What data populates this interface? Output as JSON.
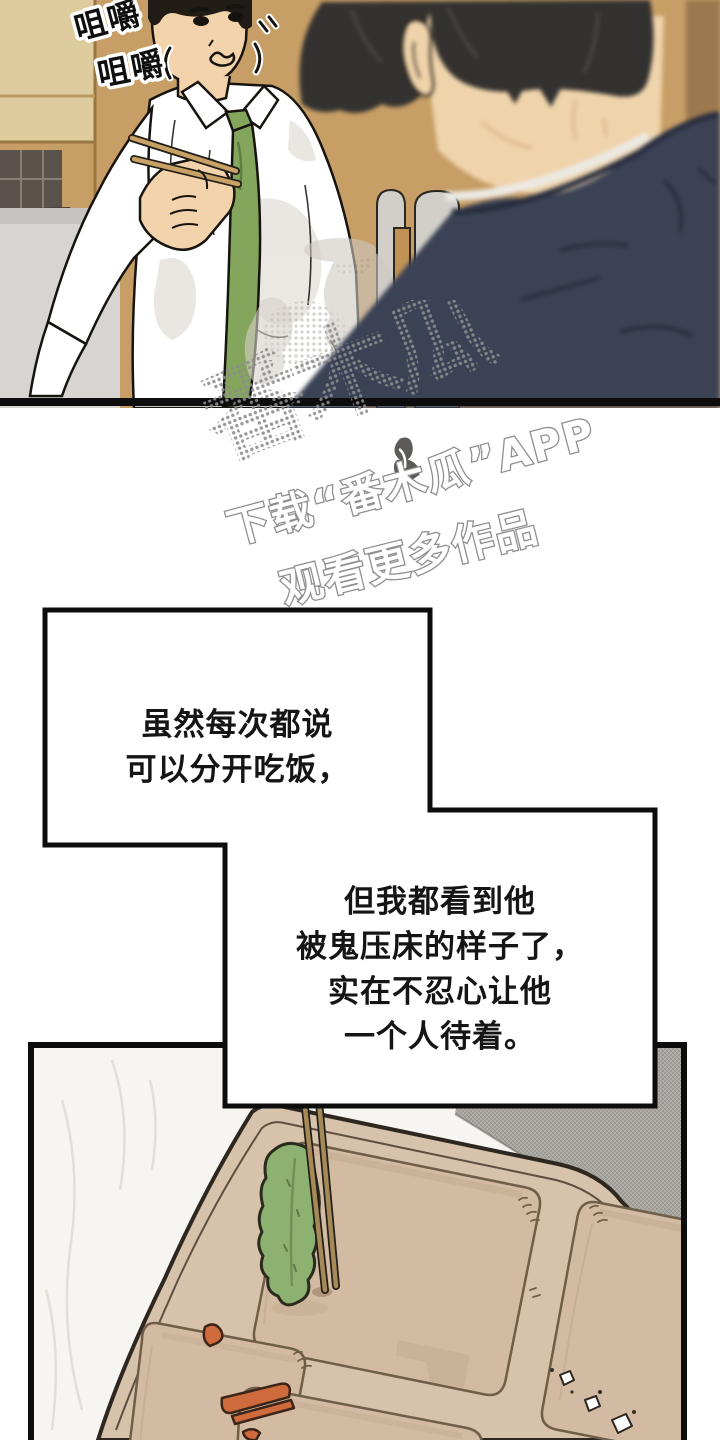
{
  "page": {
    "kind": "webtoon-comic-page"
  },
  "sfx": {
    "line1": "咀嚼",
    "line2": "咀嚼"
  },
  "watermark": {
    "logo": "番木瓜",
    "tagline1": "下载“番木瓜”APP",
    "tagline2": "观看更多作品"
  },
  "narration": {
    "box1": {
      "lines": [
        "虽然每次都说",
        "可以分开吃饭，"
      ]
    },
    "box2": {
      "lines": [
        "但我都看到他",
        "被鬼压床的样子了，",
        "实在不忍心让他",
        "一个人待着。"
      ]
    }
  },
  "colors": {
    "wood_wall": "#c79e66",
    "wood_panel_light": "#dfcc9e",
    "sofa_gray": "#d7d5d1",
    "skin": "#f2d3ab",
    "tie_green": "#84a55c",
    "suit_navy": "#3b4255",
    "chopstick_tan": "#c8a166",
    "tray_tan": "#d7c2ab",
    "leaf_green": "#8db171",
    "carrot_orange": "#cf6a3c",
    "cushion_gray": "#a7a49e",
    "watermark_gray": "#8f8f8f",
    "panel_border": "#0d0d0d"
  }
}
